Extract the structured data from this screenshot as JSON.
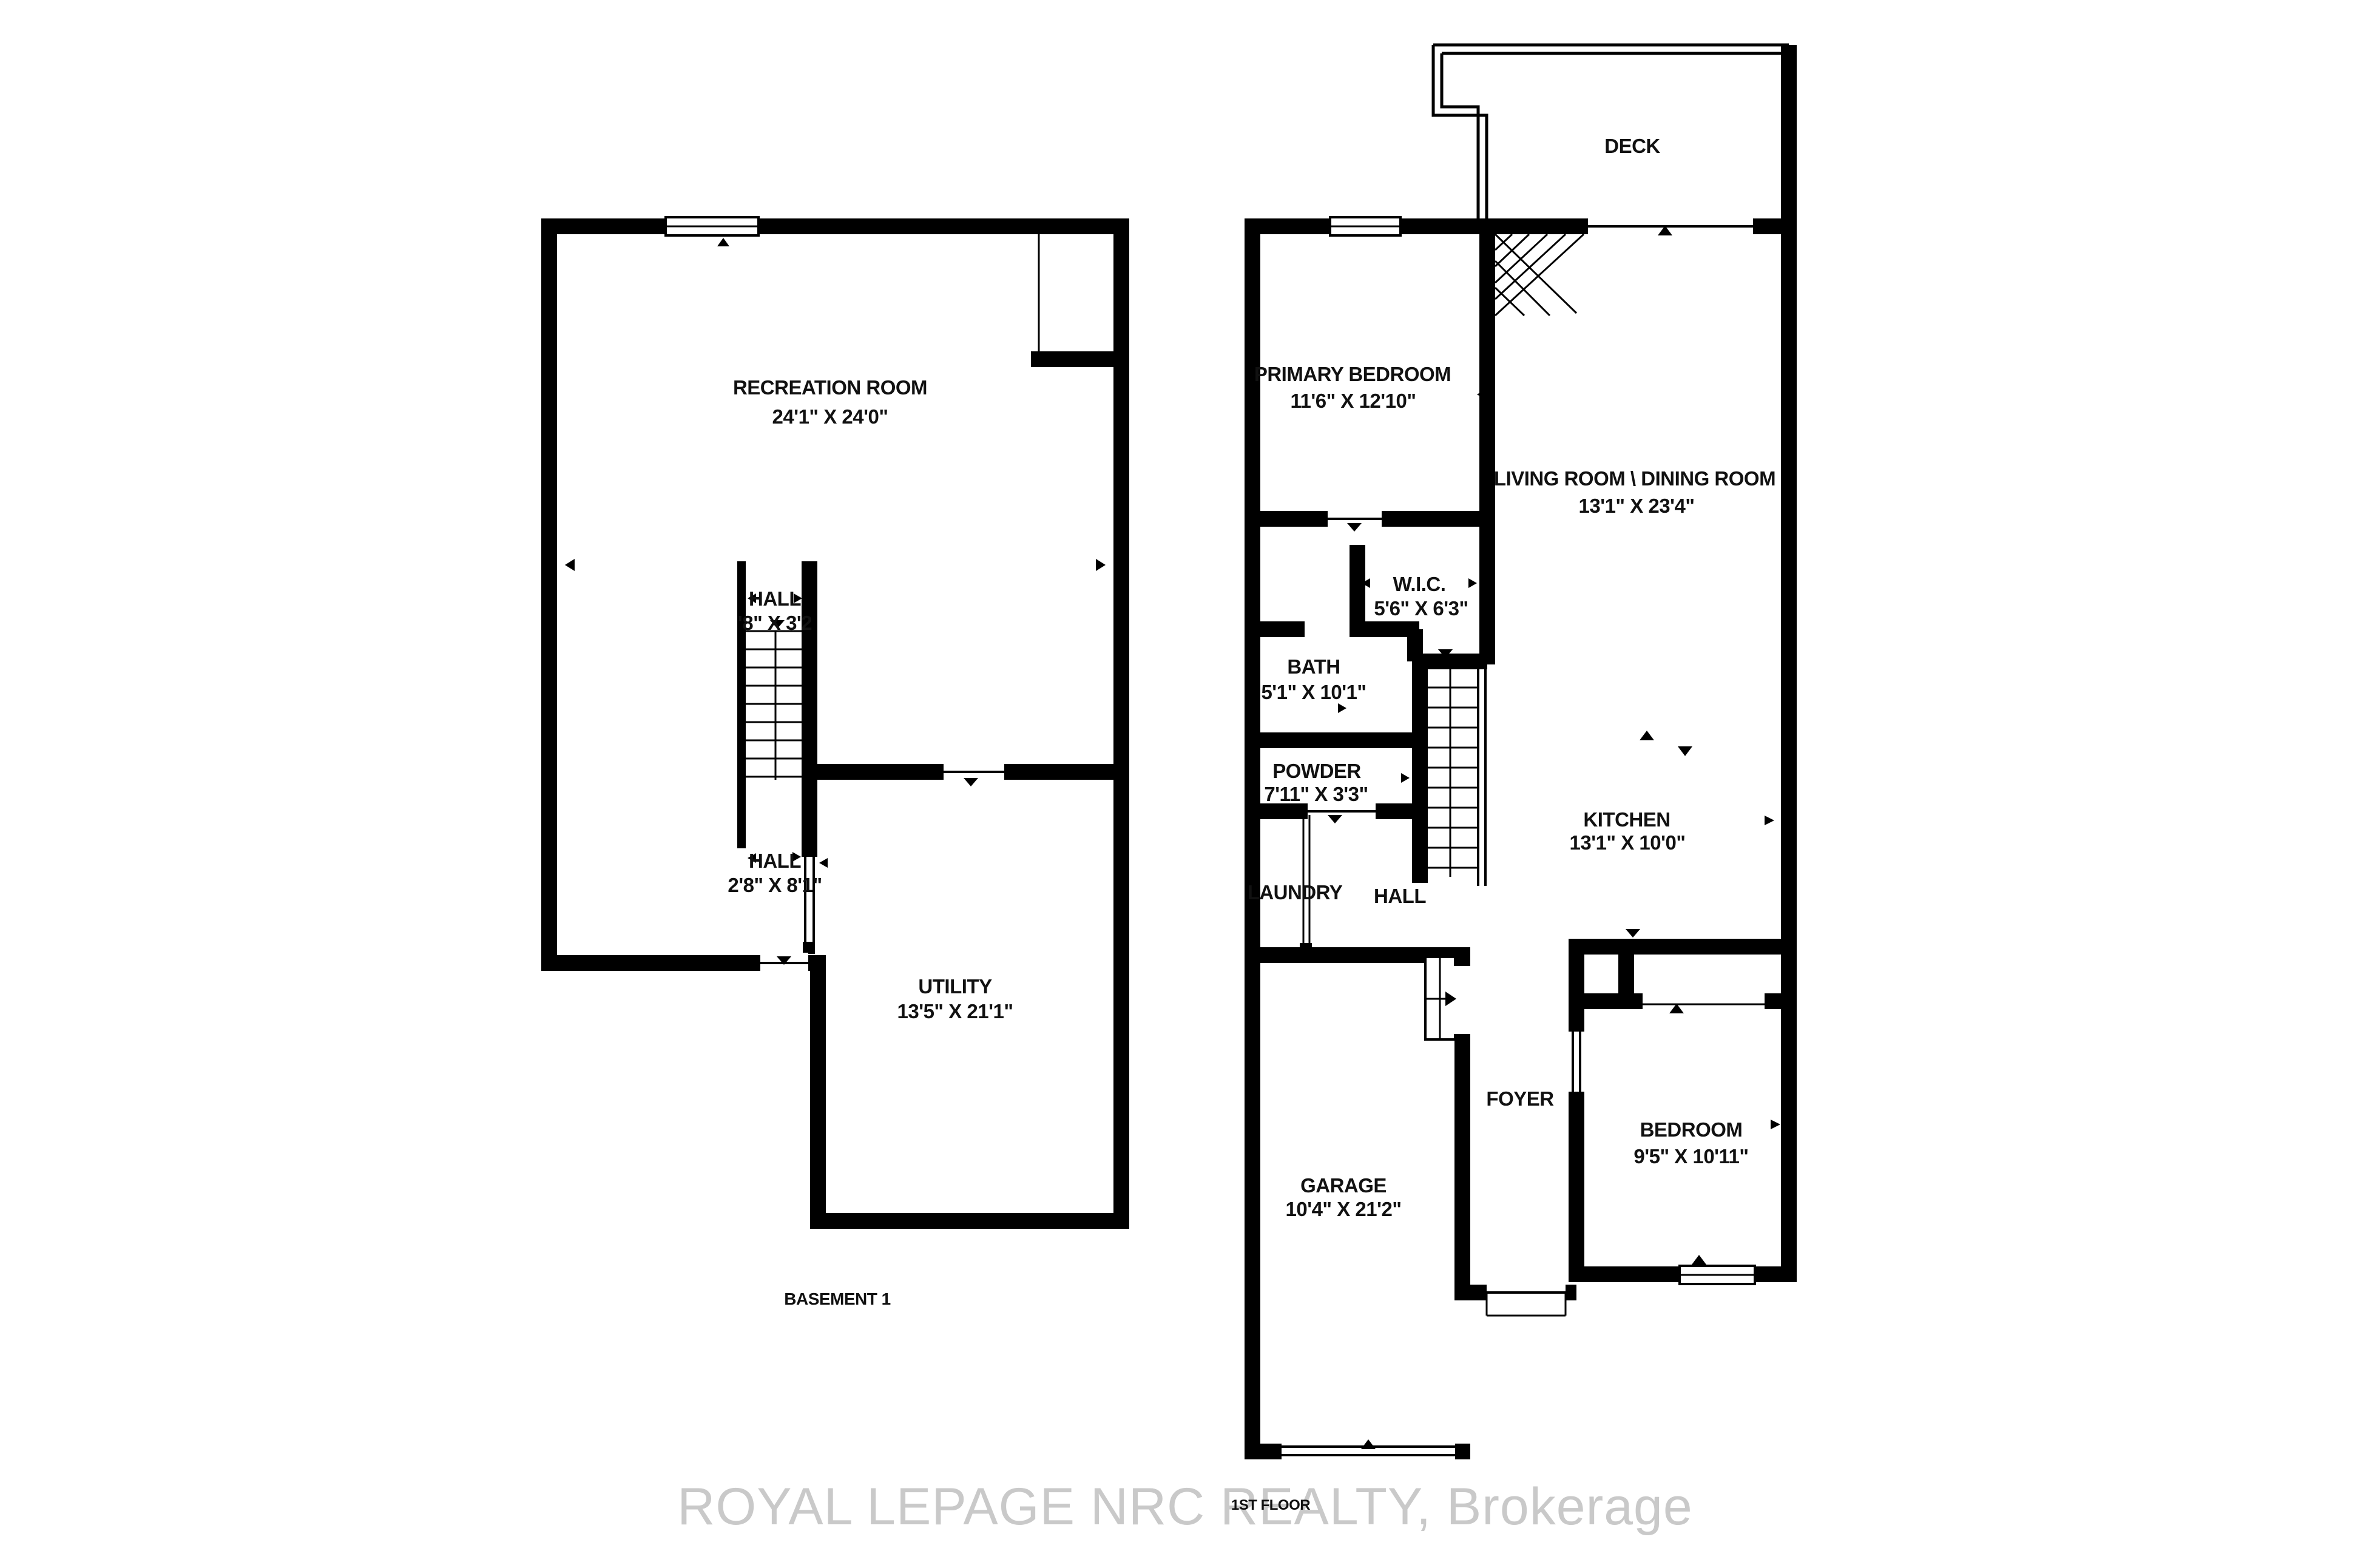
{
  "title": "Two-storey townhouse floor plan",
  "colors": {
    "background": "#ffffff",
    "walls": "#000000",
    "text": "#111111",
    "watermark": "#c9c9c9"
  },
  "watermark_text": "ROYAL LEPAGE NRC REALTY, Brokerage",
  "basement": {
    "floor_label": "BASEMENT 1",
    "recreation": {
      "name": "RECREATION ROOM",
      "dim": "24'1\" X 24'0\""
    },
    "hall_upper": {
      "name": "HALL",
      "dim": "'8\" X 3'2"
    },
    "hall_lower": {
      "name": "HALL",
      "dim": "2'8\" X 8'1\""
    },
    "utility": {
      "name": "UTILITY",
      "dim": "13'5\" X 21'1\""
    }
  },
  "first_floor": {
    "floor_label": "1ST FLOOR",
    "deck": {
      "name": "DECK"
    },
    "primary_bedroom": {
      "name": "PRIMARY BEDROOM",
      "dim": "11'6\" X 12'10\""
    },
    "living_dining": {
      "name": "LIVING ROOM \\ DINING ROOM",
      "dim": "13'1\" X 23'4\""
    },
    "wic": {
      "name": "W.I.C.",
      "dim": "5'6\" X 6'3\""
    },
    "bath": {
      "name": "BATH",
      "dim": "5'1\" X 10'1\""
    },
    "powder": {
      "name": "POWDER",
      "dim": "7'11\" X 3'3\""
    },
    "laundry": {
      "name": "LAUNDRY"
    },
    "hall": {
      "name": "HALL"
    },
    "kitchen": {
      "name": "KITCHEN",
      "dim": "13'1\" X 10'0\""
    },
    "foyer": {
      "name": "FOYER"
    },
    "bedroom": {
      "name": "BEDROOM",
      "dim": "9'5\" X 10'11\""
    },
    "garage": {
      "name": "GARAGE",
      "dim": "10'4\" X 21'2\""
    }
  }
}
